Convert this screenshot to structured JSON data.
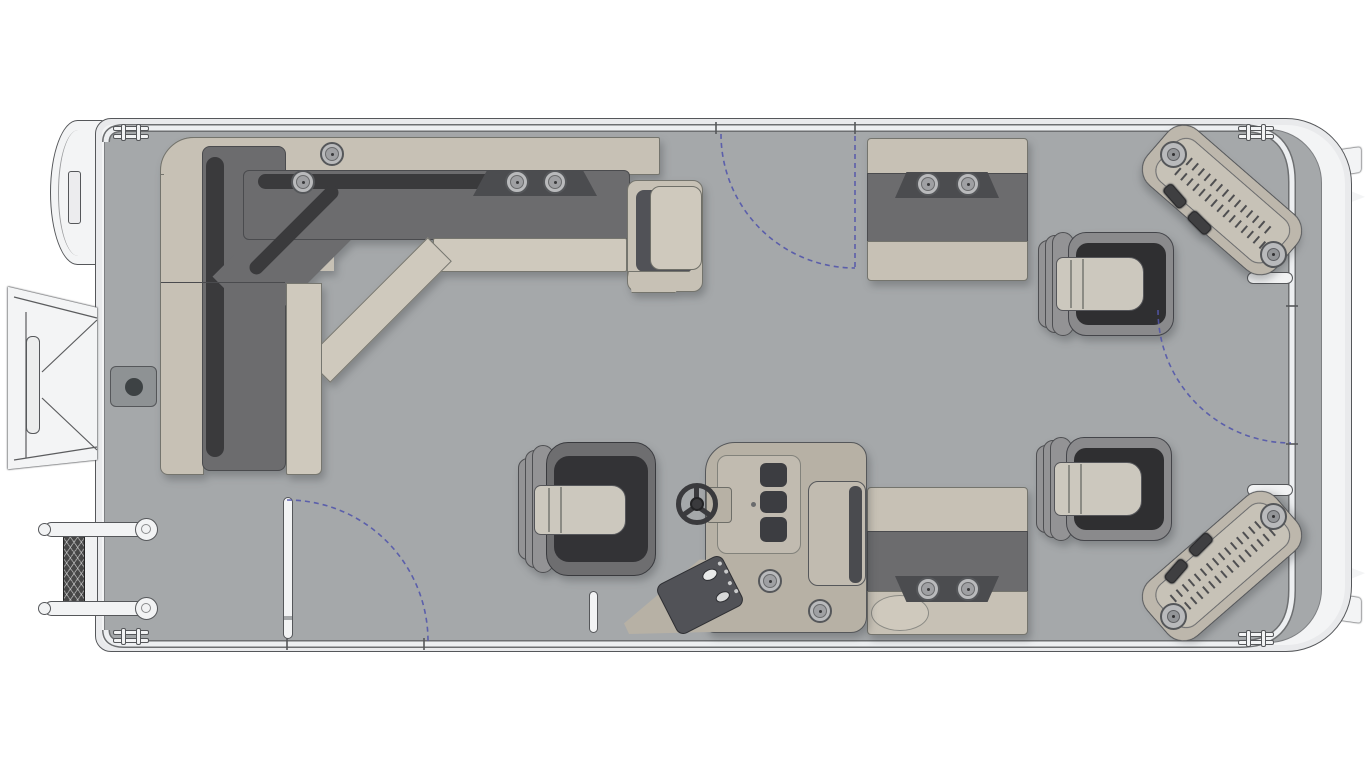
{
  "page": {
    "background": "#ffffff"
  },
  "colors": {
    "page": "#ffffff",
    "deck": "#a5a8aa",
    "hullWhite": "#f3f4f5",
    "outline": "#55575a",
    "railLight": "#edeff1",
    "railDark": "#6d6f71",
    "tan": "#c7c1b5",
    "tanLight": "#cfc9bd",
    "cushionDark": "#6c6c6e",
    "cushionShadow": "#3a3a3c",
    "insetDark": "#4b4c4f",
    "bucketShell": "#8a8a8c",
    "seatWell": "#2f2f31",
    "cushionLight": "#ccc8be",
    "chairShell": "#6e6e70",
    "consoleTan": "#b7b1a5",
    "consoleFace": "#c1bbb0",
    "panelDark": "#515257",
    "wheelDark": "#3a3a3d",
    "stepPad": "#bdb7ac",
    "stepInset": "#c7c2b7",
    "gateBlue": "#5356ab",
    "pedestalGray": "#8e9294",
    "ladderDark": "#474747"
  },
  "diagram": {
    "type": "pontoon-boat-floorplan-top-view",
    "seating": {
      "l_shaped_bow_lounge": 1,
      "bench_seats": 2,
      "bucket_seats": 2,
      "captains_chair": 1
    },
    "helm": {
      "steering_wheel": 1,
      "switch_panel": 1,
      "gauge_slots": 3,
      "console_cup_holders": 2,
      "lean_pad": 1
    },
    "cup_holders": {
      "lounge_corner": 2,
      "lounge_center": 2,
      "top_bench": 2,
      "bottom_bench": 2,
      "helm_console": 2,
      "total": 10
    },
    "gates": [
      {
        "location": "top-rail-center",
        "indicator": "dashed-swing-arc-and-open-position-line"
      },
      {
        "location": "bottom-rail-left",
        "indicator": "open-gate-bar-with-dashed-swing-arc"
      },
      {
        "location": "right-rail",
        "indicator": "dashed-swing-arc"
      }
    ],
    "deck_fittings": [
      "pedestal-table-base",
      "center-grab-post",
      "corner-step-pads",
      "grab-bars",
      "hinge-brackets",
      "bow-nose-cone",
      "open-bow-boarding-gate",
      "folding-boarding-ladder",
      "transom-fins",
      "transom-tabs"
    ],
    "swing_arc_style": {
      "color": "#5356ab",
      "dash": "5 4"
    }
  }
}
